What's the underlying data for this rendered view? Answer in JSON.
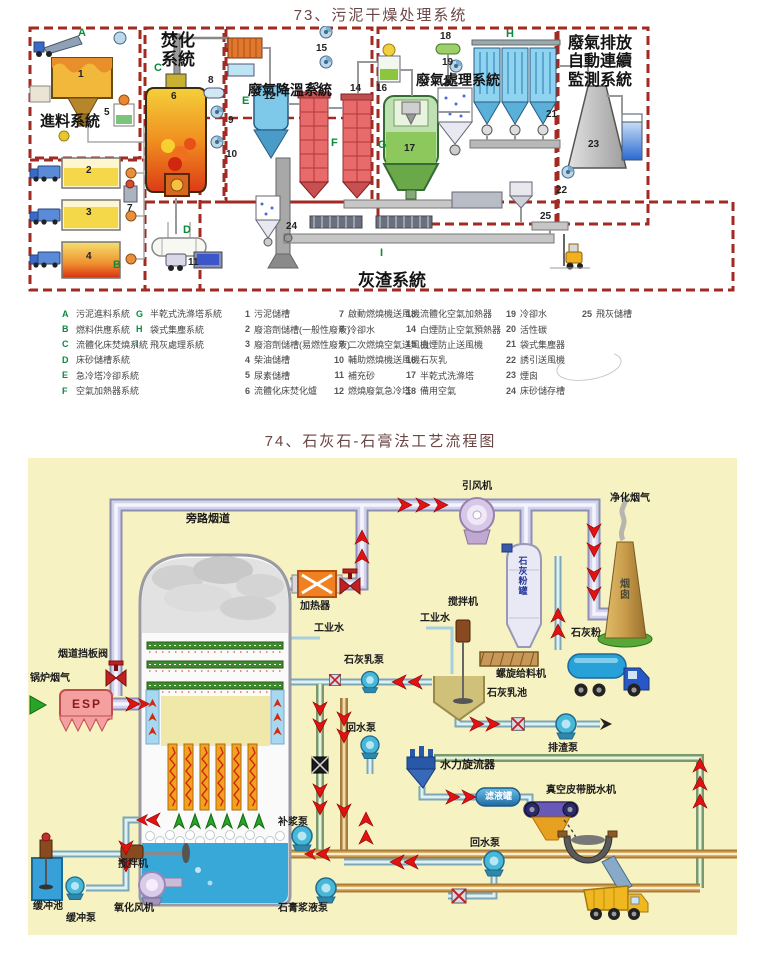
{
  "d73": {
    "title": "73、污泥干燥处理系统",
    "sections": {
      "feed": "進料系統",
      "incinerate": "焚化系統",
      "cooling": "廢氣降溫系統",
      "treatment": "廢氣處理系統",
      "monitoring": "廢氣排放自動連續監測系統",
      "ash": "灰渣系統"
    },
    "legend_letters": [
      {
        "k": "A",
        "v": "污泥進料系統"
      },
      {
        "k": "B",
        "v": "燃料供應系統"
      },
      {
        "k": "C",
        "v": "流體化床焚燒系統"
      },
      {
        "k": "D",
        "v": "床砂儲槽系統"
      },
      {
        "k": "E",
        "v": "急冷塔冷卻系統"
      },
      {
        "k": "F",
        "v": "空氣加熱器系統"
      },
      {
        "k": "G",
        "v": "半乾式洗滌塔系統"
      },
      {
        "k": "H",
        "v": "袋式集塵系統"
      },
      {
        "k": "I",
        "v": "飛灰處理系統"
      }
    ],
    "legend_items": [
      {
        "k": "1",
        "v": "污泥儲槽"
      },
      {
        "k": "2",
        "v": "廢溶劑儲槽(一般性廢液)"
      },
      {
        "k": "3",
        "v": "廢溶劑儲槽(易燃性廢液)"
      },
      {
        "k": "4",
        "v": "柴油儲槽"
      },
      {
        "k": "5",
        "v": "尿素儲槽"
      },
      {
        "k": "6",
        "v": "流體化床焚化爐"
      },
      {
        "k": "7",
        "v": "啟動燃燒機送風機"
      },
      {
        "k": "8",
        "v": "冷卻水"
      },
      {
        "k": "9",
        "v": "二次燃燒空氣送風機"
      },
      {
        "k": "10",
        "v": "輔助燃燒機送風機"
      },
      {
        "k": "11",
        "v": "補充砂"
      },
      {
        "k": "12",
        "v": "燃燒廢氣急冷塔"
      },
      {
        "k": "13",
        "v": "流體化空氣加熱器"
      },
      {
        "k": "14",
        "v": "白煙防止空氣預熱器"
      },
      {
        "k": "15",
        "v": "白煙防止送風機"
      },
      {
        "k": "16",
        "v": "石灰乳"
      },
      {
        "k": "17",
        "v": "半乾式洗滌塔"
      },
      {
        "k": "18",
        "v": "備用空氣"
      },
      {
        "k": "19",
        "v": "冷卻水"
      },
      {
        "k": "20",
        "v": "活性碳"
      },
      {
        "k": "21",
        "v": "袋式集塵器"
      },
      {
        "k": "22",
        "v": "誘引送風機"
      },
      {
        "k": "23",
        "v": "煙囪"
      },
      {
        "k": "24",
        "v": "床砂儲存槽"
      },
      {
        "k": "25",
        "v": "飛灰儲槽"
      }
    ]
  },
  "d74": {
    "title": "74、石灰石-石膏法工艺流程图",
    "labels": {
      "boiler_flue_gas": "锅炉烟气",
      "esp": "ESP",
      "damper": "烟道挡板阀",
      "bypass": "旁路烟道",
      "heater": "加热器",
      "industrial_water_tower": "工业水",
      "id_fan": "引风机",
      "clean_gas": "净化烟气",
      "chimney": "烟囱",
      "lime_silo": "石灰粉罐",
      "mixer_silo": "搅拌机",
      "industrial_water_mixer": "工业水",
      "screw_feeder": "螺旋给料机",
      "lime_pool": "石灰乳池",
      "lime_pump": "石灰乳泵",
      "lime_powder": "石灰粉",
      "drain_pump": "排渣泵",
      "return_pump_upper": "回水泵",
      "supply_pump": "补浆泵",
      "mixer_tower": "搅拌机",
      "buffer_pool": "缓冲池",
      "buffer_pump": "缓冲泵",
      "oxidation_fan": "氧化风机",
      "gypsum_pump": "石膏浆液泵",
      "hydrocyclone": "水力旋流器",
      "filtrate_tank": "滤液罐",
      "vacuum_belt": "真空皮带脱水机",
      "return_pump_lower": "回水泵"
    }
  }
}
